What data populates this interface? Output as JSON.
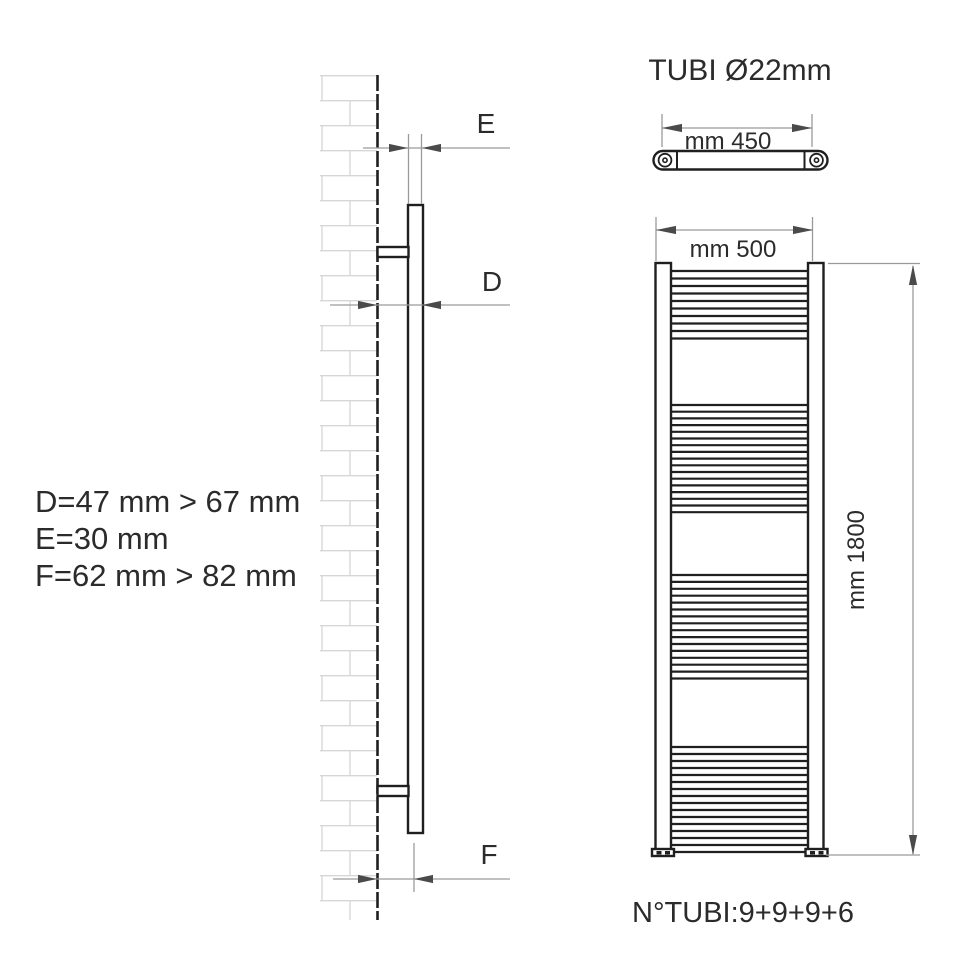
{
  "side_view": {
    "labels": {
      "e": "E",
      "d": "D",
      "f": "F"
    }
  },
  "legend": {
    "lines": [
      "D=47 mm > 67 mm",
      "E=30 mm",
      "F=62 mm > 82 mm"
    ]
  },
  "front_view": {
    "title": "TUBI Ø22mm",
    "tube_length_label": "mm 450",
    "width_label": "mm 500",
    "height_label": "mm 1800",
    "tube_count_label": "N°TUBI:9+9+9+6",
    "rung_x1": 671,
    "rung_x2": 808,
    "rung_groups": [
      {
        "count": 10,
        "y_start": 271,
        "pitch": 7.5
      },
      {
        "count": 17,
        "y_start": 405,
        "pitch": 6.7
      },
      {
        "count": 16,
        "y_start": 575,
        "pitch": 6.9
      },
      {
        "count": 16,
        "y_start": 747,
        "pitch": 7.0
      }
    ]
  },
  "dimensions": {
    "tube_diameter_mm": 22,
    "tube_length_mm": 450,
    "width_mm": 500,
    "height_mm": 1800,
    "d_range_mm": "47 > 67",
    "e_mm": 30,
    "f_range_mm": "62 > 82",
    "tube_counts": [
      9,
      9,
      9,
      6
    ]
  },
  "colors": {
    "background": "#ffffff",
    "line": "#1f1f1f",
    "dim_line": "#9a9a9a",
    "arrow": "#4a4a4a",
    "brick": "#d6d6d6",
    "text": "#2b2b2b"
  }
}
